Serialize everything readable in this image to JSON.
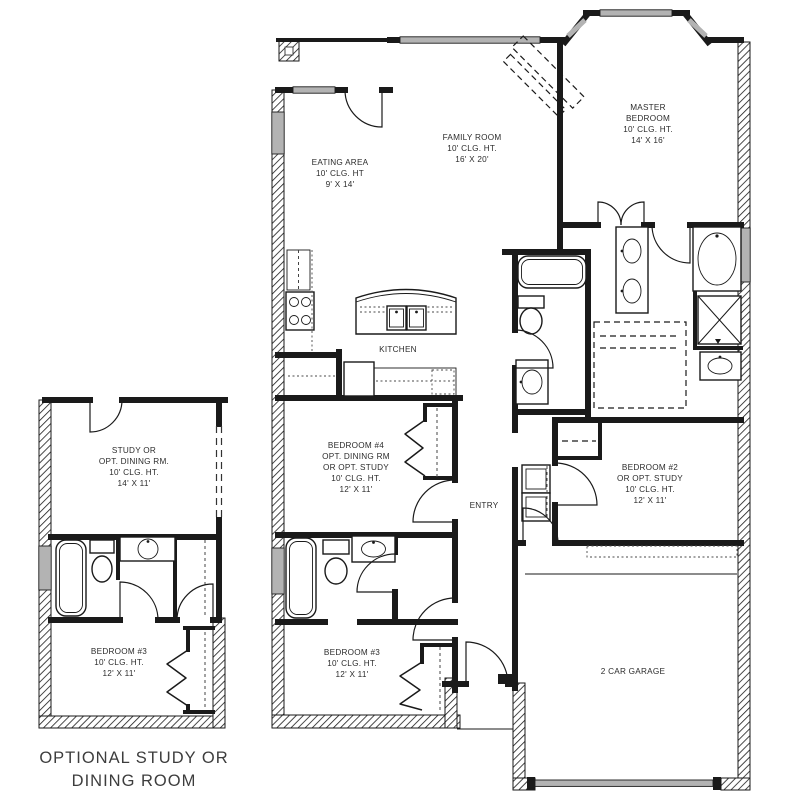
{
  "colors": {
    "ink": "#1a1a1a",
    "window_gray": "#b3b3b3",
    "caption_gray": "#3d3d3d",
    "background": "#ffffff"
  },
  "caption": {
    "lines": [
      "OPTIONAL STUDY OR",
      "DINING ROOM"
    ]
  },
  "rooms": {
    "master": {
      "lines": [
        "MASTER",
        "BEDROOM",
        "10' CLG. HT.",
        "14' X 16'"
      ]
    },
    "family": {
      "lines": [
        "FAMILY ROOM",
        "10' CLG. HT.",
        "16' X 20'"
      ]
    },
    "eating": {
      "lines": [
        "EATING AREA",
        "10' CLG. HT",
        "9' X 14'"
      ]
    },
    "kitchen": {
      "lines": [
        "KITCHEN"
      ]
    },
    "bedroom4": {
      "lines": [
        "BEDROOM #4",
        "OPT. DINING RM",
        "OR OPT. STUDY",
        "10' CLG. HT.",
        "12' X 11'"
      ]
    },
    "entry": {
      "lines": [
        "ENTRY"
      ]
    },
    "bedroom2": {
      "lines": [
        "BEDROOM #2",
        "OR OPT. STUDY",
        "10' CLG. HT.",
        "12' X 11'"
      ]
    },
    "bedroom3_main": {
      "lines": [
        "BEDROOM #3",
        "10' CLG. HT.",
        "12' X 11'"
      ]
    },
    "garage": {
      "lines": [
        "2 CAR GARAGE"
      ]
    },
    "inset_study": {
      "lines": [
        "STUDY OR",
        "OPT. DINING RM.",
        "10' CLG. HT.",
        "14' X 11'"
      ]
    },
    "inset_bedroom3": {
      "lines": [
        "BEDROOM #3",
        "10' CLG. HT.",
        "12' X 11'"
      ]
    }
  },
  "fixtures": [
    "bathtub",
    "garden-tub",
    "toilet",
    "sink",
    "double-sink",
    "cooktop",
    "refrigerator",
    "kitchen-island",
    "shower",
    "closet-rod",
    "bifold-door",
    "linen-shelves",
    "garage-door",
    "window",
    "door-swing",
    "optional-fireplace"
  ]
}
